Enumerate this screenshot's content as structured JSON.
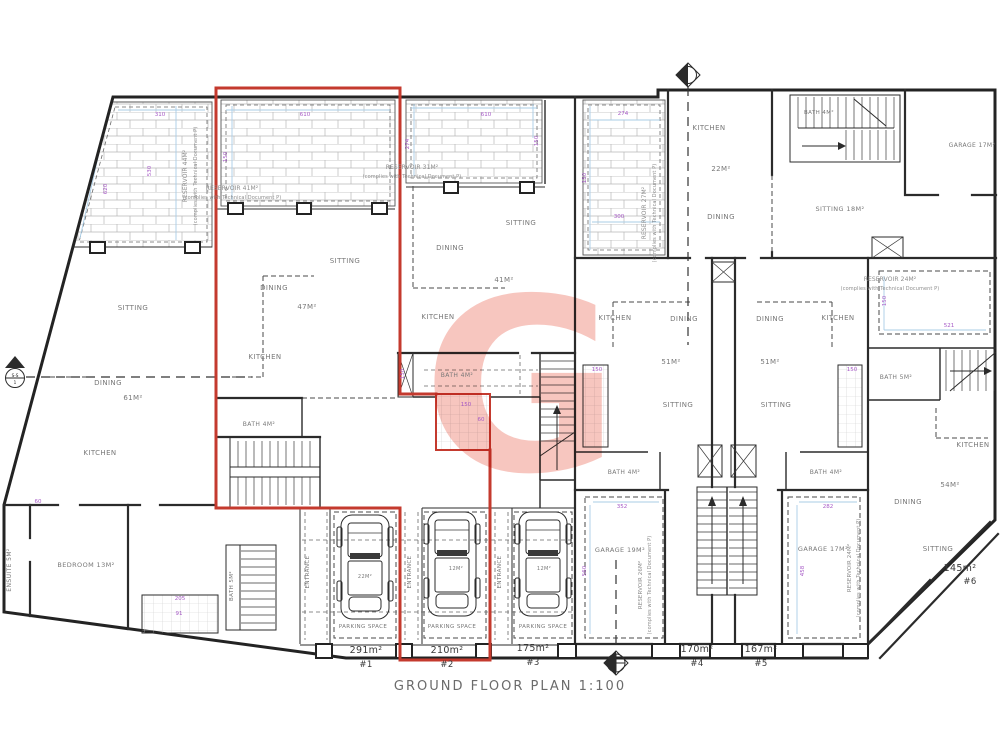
{
  "drawing_title": "GROUND FLOOR PLAN 1:100",
  "watermark": "G",
  "colors": {
    "highlight": "#c43a2e",
    "dimension": "#a659c6",
    "guide_line": "#a9cde6",
    "wall": "#2b2b2b",
    "room_label": "#787878",
    "watermark": "#f6bcb4"
  },
  "units": [
    {
      "id": "#1",
      "area": "291m²"
    },
    {
      "id": "#2",
      "area": "210m²",
      "highlighted": true
    },
    {
      "id": "#3",
      "area": "175m²"
    },
    {
      "id": "#4",
      "area": "170m²"
    },
    {
      "id": "#5",
      "area": "167m²"
    },
    {
      "id": "#6",
      "area": "145m²"
    }
  ],
  "section_marker_label": {
    "line1": "S-S",
    "line2": "1"
  },
  "plan": {
    "labels": [
      {
        "t": "SITTING",
        "x": 133,
        "y": 310
      },
      {
        "t": "DINING",
        "x": 108,
        "y": 385
      },
      {
        "t": "61M²",
        "x": 133,
        "y": 400
      },
      {
        "t": "KITCHEN",
        "x": 100,
        "y": 455
      },
      {
        "t": "BEDROOM 13M²",
        "x": 86,
        "y": 567,
        "s": 6.5
      },
      {
        "t": "ENSUITE 5M²",
        "x": 11,
        "y": 570,
        "r": -90,
        "s": 6
      },
      {
        "t": "BATH 5M²",
        "x": 233,
        "y": 586,
        "r": -90,
        "s": 5.5
      },
      {
        "t": "SITTING",
        "x": 345,
        "y": 263
      },
      {
        "t": "DINING",
        "x": 274,
        "y": 290
      },
      {
        "t": "47M²",
        "x": 307,
        "y": 309
      },
      {
        "t": "KITCHEN",
        "x": 265,
        "y": 359
      },
      {
        "t": "BATH 4M²",
        "x": 259,
        "y": 426,
        "s": 6
      },
      {
        "t": "SITTING",
        "x": 521,
        "y": 225
      },
      {
        "t": "DINING",
        "x": 450,
        "y": 250
      },
      {
        "t": "41M²",
        "x": 504,
        "y": 282
      },
      {
        "t": "KITCHEN",
        "x": 438,
        "y": 319
      },
      {
        "t": "BATH 4M²",
        "x": 457,
        "y": 377,
        "s": 6
      },
      {
        "t": "KITCHEN",
        "x": 709,
        "y": 130
      },
      {
        "t": "22M²",
        "x": 721,
        "y": 171
      },
      {
        "t": "DINING",
        "x": 721,
        "y": 219
      },
      {
        "t": "BATH 4M²",
        "x": 819,
        "y": 114,
        "s": 5.5
      },
      {
        "t": "GARAGE 17M²",
        "x": 972,
        "y": 147,
        "s": 6
      },
      {
        "t": "SITTING 18M²",
        "x": 840,
        "y": 211,
        "s": 6.5
      },
      {
        "t": "KITCHEN",
        "x": 615,
        "y": 320
      },
      {
        "t": "DINING",
        "x": 684,
        "y": 321
      },
      {
        "t": "51M²",
        "x": 671,
        "y": 364
      },
      {
        "t": "SITTING",
        "x": 678,
        "y": 407
      },
      {
        "t": "BATH 4M²",
        "x": 624,
        "y": 474,
        "s": 6
      },
      {
        "t": "GARAGE 19M²",
        "x": 620,
        "y": 552,
        "s": 6.5
      },
      {
        "t": "DINING",
        "x": 770,
        "y": 321
      },
      {
        "t": "KITCHEN",
        "x": 838,
        "y": 320
      },
      {
        "t": "51M²",
        "x": 770,
        "y": 364
      },
      {
        "t": "SITTING",
        "x": 776,
        "y": 407
      },
      {
        "t": "BATH 4M²",
        "x": 826,
        "y": 474,
        "s": 6
      },
      {
        "t": "GARAGE 17M²",
        "x": 823,
        "y": 551,
        "s": 6.5
      },
      {
        "t": "BATH 5M²",
        "x": 896,
        "y": 379,
        "s": 6
      },
      {
        "t": "KITCHEN",
        "x": 973,
        "y": 447
      },
      {
        "t": "54M²",
        "x": 950,
        "y": 487
      },
      {
        "t": "DINING",
        "x": 908,
        "y": 504
      },
      {
        "t": "SITTING",
        "x": 938,
        "y": 551
      },
      {
        "t": "ENTRANCE",
        "x": 309,
        "y": 572,
        "r": -90,
        "s": 5.5
      },
      {
        "t": "ENTRANCE",
        "x": 411,
        "y": 572,
        "r": -90,
        "s": 5.5
      },
      {
        "t": "ENTRANCE",
        "x": 501,
        "y": 572,
        "r": -90,
        "s": 5.5
      },
      {
        "t": "PARKING SPACE",
        "x": 363,
        "y": 628,
        "s": 5.5
      },
      {
        "t": "PARKING SPACE",
        "x": 452,
        "y": 628,
        "s": 5.5
      },
      {
        "t": "PARKING SPACE",
        "x": 543,
        "y": 628,
        "s": 5.5
      },
      {
        "t": "22M²",
        "x": 365,
        "y": 578,
        "s": 5
      },
      {
        "t": "12M²",
        "x": 456,
        "y": 570,
        "s": 5
      },
      {
        "t": "12M²",
        "x": 544,
        "y": 570,
        "s": 5
      },
      {
        "t": "RESERVOIR 44M²",
        "x": 187,
        "y": 176,
        "r": -90,
        "s": 6,
        "k": "note"
      },
      {
        "t": "(complies with Technical Document P)",
        "x": 197,
        "y": 176,
        "r": -90,
        "s": 5,
        "k": "note"
      },
      {
        "t": "RESERVOIR 41M²",
        "x": 232,
        "y": 190,
        "s": 6,
        "k": "note",
        "a": "start"
      },
      {
        "t": "(complies with Technical Document P)",
        "x": 232,
        "y": 199,
        "s": 5,
        "k": "note",
        "a": "start"
      },
      {
        "t": "RESERVOIR 31M²",
        "x": 412,
        "y": 169,
        "s": 6,
        "k": "note",
        "a": "start"
      },
      {
        "t": "(complies with Technical Document P)",
        "x": 412,
        "y": 178,
        "s": 5,
        "k": "note",
        "a": "start"
      },
      {
        "t": "RESERVOIR 27M²",
        "x": 646,
        "y": 213,
        "r": -90,
        "s": 6,
        "k": "note"
      },
      {
        "t": "(complies with Technical Document P)",
        "x": 656,
        "y": 213,
        "r": -90,
        "s": 5,
        "k": "note"
      },
      {
        "t": "RESERVOIR 26M²",
        "x": 642,
        "y": 585,
        "r": -90,
        "s": 5.5,
        "k": "note"
      },
      {
        "t": "(complies with Technical Document P)",
        "x": 651,
        "y": 585,
        "r": -90,
        "s": 5,
        "k": "note"
      },
      {
        "t": "RESERVOIR 24M²",
        "x": 851,
        "y": 568,
        "r": -90,
        "s": 5.5,
        "k": "note"
      },
      {
        "t": "(complies with Technical Document P)",
        "x": 860,
        "y": 568,
        "r": -90,
        "s": 5,
        "k": "note"
      },
      {
        "t": "RESERVOIR 24M²",
        "x": 890,
        "y": 281,
        "s": 6,
        "k": "note",
        "a": "start"
      },
      {
        "t": "(complies with Technical Document P)",
        "x": 890,
        "y": 290,
        "s": 5,
        "k": "note",
        "a": "start"
      },
      {
        "t": "291m²",
        "x": 366,
        "y": 653,
        "k": "area"
      },
      {
        "t": "#1",
        "x": 366,
        "y": 667,
        "k": "unit"
      },
      {
        "t": "210m²",
        "x": 447,
        "y": 653,
        "k": "area"
      },
      {
        "t": "#2",
        "x": 447,
        "y": 667,
        "k": "unit"
      },
      {
        "t": "175m²",
        "x": 533,
        "y": 651,
        "k": "area"
      },
      {
        "t": "#3",
        "x": 533,
        "y": 665,
        "k": "unit"
      },
      {
        "t": "170m²",
        "x": 697,
        "y": 652,
        "k": "area"
      },
      {
        "t": "#4",
        "x": 697,
        "y": 666,
        "k": "unit"
      },
      {
        "t": "167m²",
        "x": 761,
        "y": 652,
        "k": "area"
      },
      {
        "t": "#5",
        "x": 761,
        "y": 666,
        "k": "unit"
      },
      {
        "t": "145m²",
        "x": 960,
        "y": 571,
        "k": "area"
      },
      {
        "t": "#6",
        "x": 970,
        "y": 584,
        "k": "unit"
      },
      {
        "t": "GROUND FLOOR PLAN 1:100",
        "x": 510,
        "y": 690,
        "k": "title"
      },
      {
        "t": "310",
        "x": 160,
        "y": 116,
        "k": "dim"
      },
      {
        "t": "530",
        "x": 151,
        "y": 171,
        "r": -90,
        "k": "dim"
      },
      {
        "t": "620",
        "x": 107,
        "y": 189,
        "r": -90,
        "k": "dim"
      },
      {
        "t": "610",
        "x": 305,
        "y": 116,
        "k": "dim"
      },
      {
        "t": "150",
        "x": 227,
        "y": 157,
        "r": -90,
        "k": "dim"
      },
      {
        "t": "610",
        "x": 486,
        "y": 116,
        "k": "dim"
      },
      {
        "t": "274",
        "x": 409,
        "y": 144,
        "r": -90,
        "k": "dim"
      },
      {
        "t": "150",
        "x": 538,
        "y": 141,
        "r": -90,
        "k": "dim"
      },
      {
        "t": "274",
        "x": 623,
        "y": 115,
        "k": "dim"
      },
      {
        "t": "150",
        "x": 586,
        "y": 178,
        "r": -90,
        "k": "dim"
      },
      {
        "t": "300",
        "x": 619,
        "y": 218,
        "k": "dim"
      },
      {
        "t": "521",
        "x": 949,
        "y": 327,
        "k": "dim"
      },
      {
        "t": "150",
        "x": 886,
        "y": 301,
        "r": -90,
        "k": "dim"
      },
      {
        "t": "352",
        "x": 622,
        "y": 508,
        "k": "dim"
      },
      {
        "t": "560",
        "x": 586,
        "y": 571,
        "r": -90,
        "k": "dim"
      },
      {
        "t": "282",
        "x": 828,
        "y": 508,
        "k": "dim"
      },
      {
        "t": "458",
        "x": 804,
        "y": 571,
        "r": -90,
        "k": "dim"
      },
      {
        "t": "150",
        "x": 466,
        "y": 406,
        "k": "dim"
      },
      {
        "t": "60",
        "x": 481,
        "y": 421,
        "k": "dim"
      },
      {
        "t": "150",
        "x": 404,
        "y": 374,
        "r": -90,
        "k": "dim"
      },
      {
        "t": "150",
        "x": 597,
        "y": 371,
        "k": "dim"
      },
      {
        "t": "150",
        "x": 852,
        "y": 371,
        "k": "dim"
      },
      {
        "t": "205",
        "x": 180,
        "y": 600,
        "k": "dim"
      },
      {
        "t": "91",
        "x": 179,
        "y": 615,
        "k": "dim"
      },
      {
        "t": "60",
        "x": 38,
        "y": 503,
        "k": "dim"
      },
      {
        "t": "S-S",
        "x": 15,
        "y": 377,
        "k": "marker"
      },
      {
        "t": "1",
        "x": 15,
        "y": 384,
        "k": "marker"
      }
    ]
  }
}
